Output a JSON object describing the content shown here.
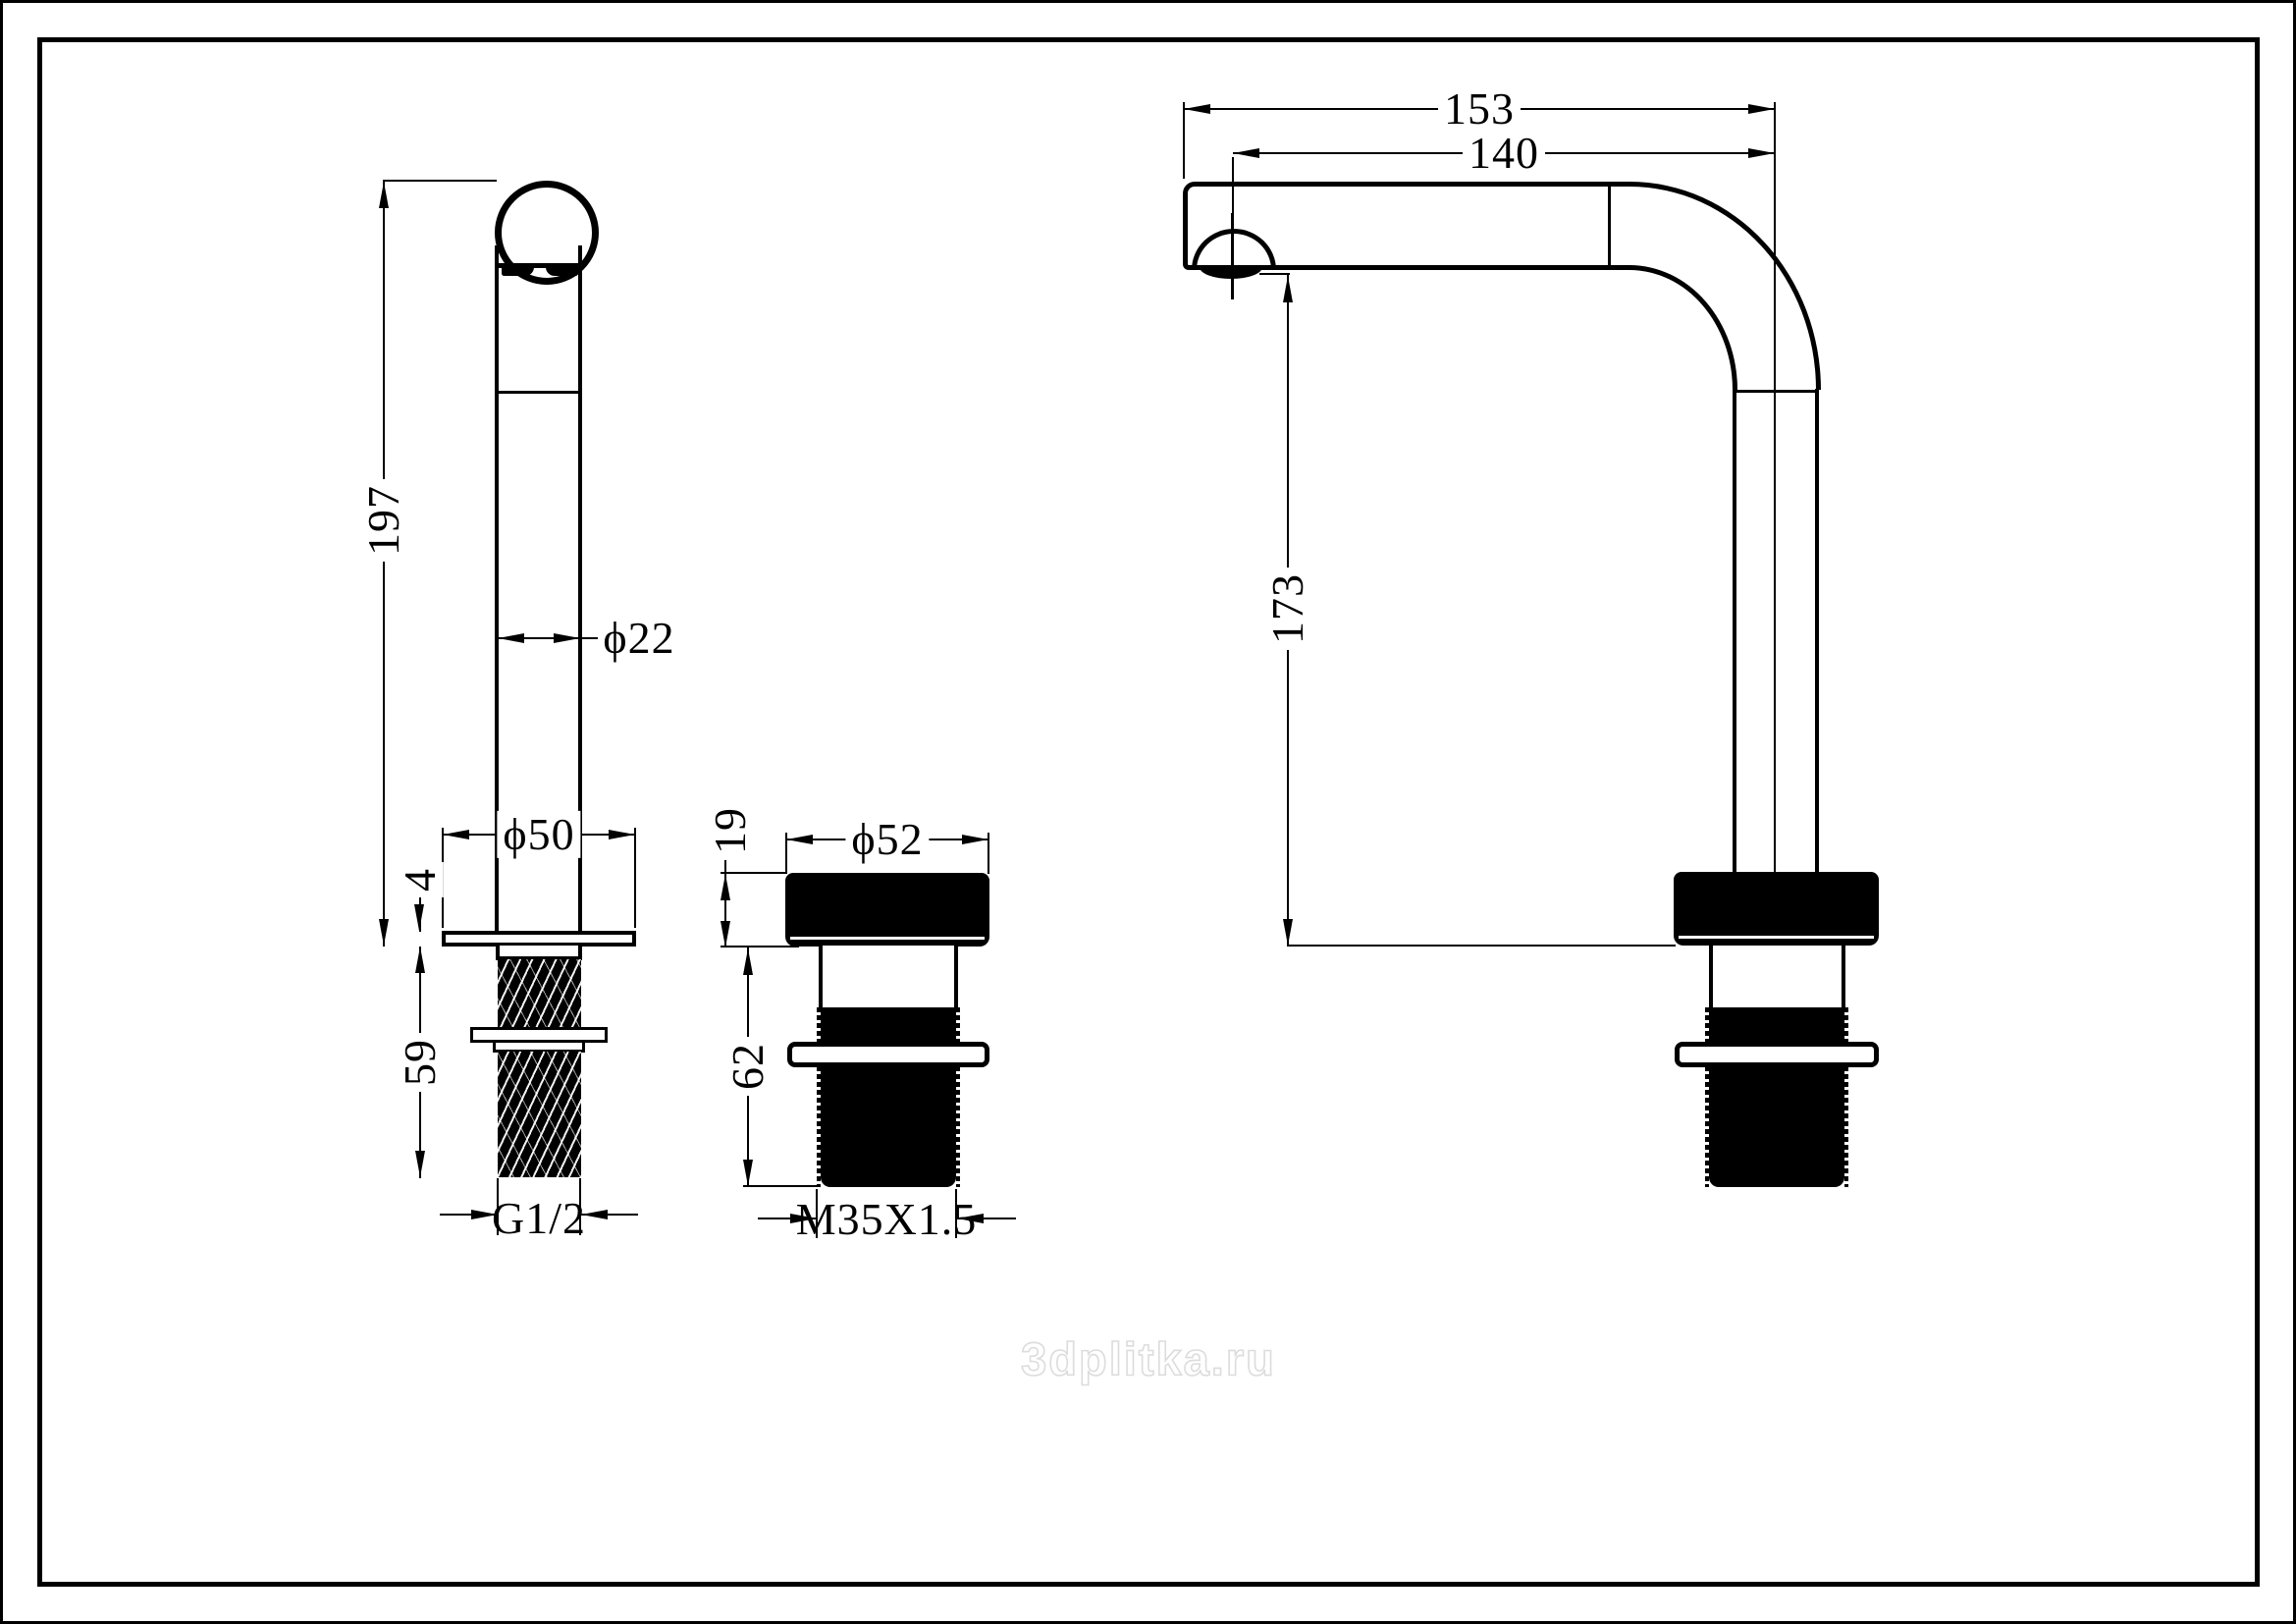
{
  "watermark": "3dplitka.ru",
  "diagram": {
    "handle_view": {
      "height": "197",
      "stem_diameter": "ϕ22",
      "flange_diameter": "ϕ50",
      "flange_thickness": "4",
      "thread_length": "59",
      "thread_spec": "G1/2"
    },
    "shank_view": {
      "cap_thickness": "19",
      "cap_diameter": "ϕ52",
      "body_length": "62",
      "thread_spec": "M35X1.5"
    },
    "spout_view": {
      "total_reach": "153",
      "outlet_reach": "140",
      "outlet_height": "173"
    }
  }
}
